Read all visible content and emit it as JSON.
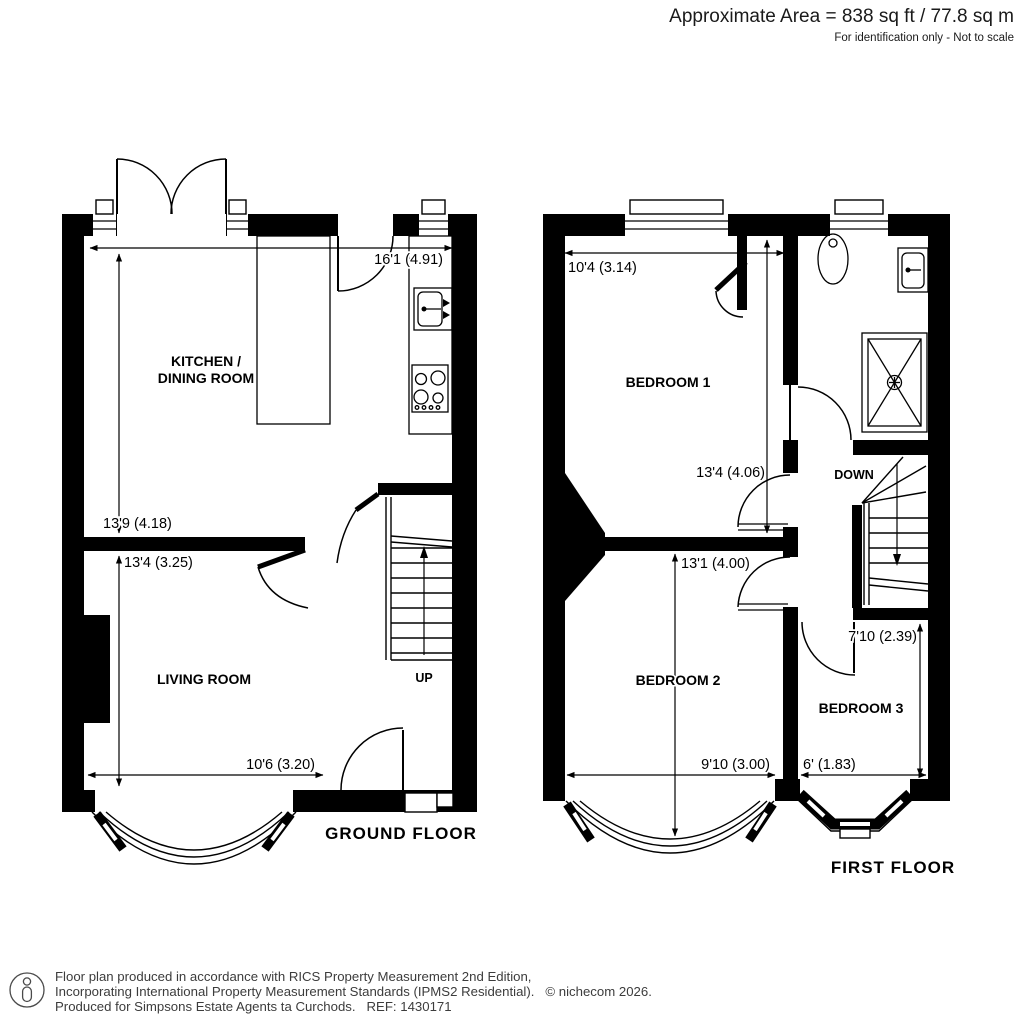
{
  "header": {
    "area": "Approximate Area = 838 sq ft / 77.8 sq m",
    "note": "For identification only - Not to scale"
  },
  "ground_floor": {
    "title": "GROUND FLOOR",
    "kitchen": {
      "label1": "KITCHEN /",
      "label2": "DINING ROOM",
      "width": "16'1 (4.91)",
      "depth": "13'9 (4.18)"
    },
    "living_room": {
      "label": "LIVING ROOM",
      "depth": "13'4 (3.25)",
      "width": "10'6 (3.20)"
    },
    "stairs": {
      "label": "UP"
    }
  },
  "first_floor": {
    "title": "FIRST FLOOR",
    "bedroom1": {
      "label": "BEDROOM 1",
      "width": "10'4 (3.14)",
      "depth": "13'4 (4.06)"
    },
    "bedroom2": {
      "label": "BEDROOM 2",
      "depth": "13'1 (4.00)",
      "width": "9'10 (3.00)"
    },
    "bedroom3": {
      "label": "BEDROOM 3",
      "depth": "7'10 (2.39)",
      "width": "6' (1.83)"
    },
    "stairs": {
      "label": "DOWN"
    }
  },
  "footer": {
    "line1": "Floor plan produced in accordance with RICS Property Measurement 2nd Edition,",
    "line2": "Incorporating International Property Measurement Standards (IPMS2 Residential).   © nichecom 2026.",
    "line3": "Produced for Simpsons Estate Agents ta Curchods.   REF: 1430171"
  },
  "colors": {
    "wall": "#000000",
    "background": "#ffffff",
    "text": "#000000"
  }
}
